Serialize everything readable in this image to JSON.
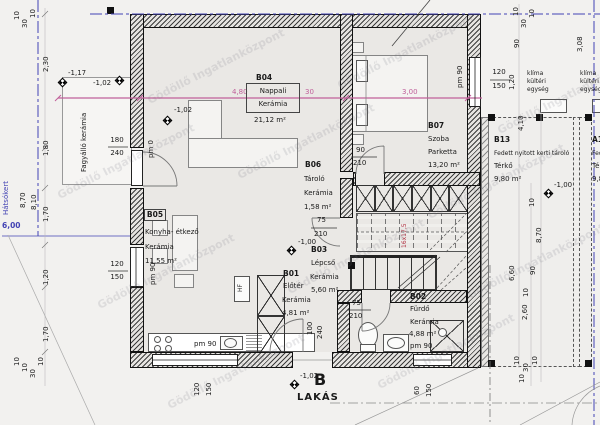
{
  "watermark": "Gödöllő Ingatlanközpont",
  "title": {
    "letter": "B",
    "word": "LAKÁS"
  },
  "rooms": {
    "b01": {
      "id": "B01",
      "name": "Előtér",
      "floor": "Kerámia",
      "area": "4,81 m²"
    },
    "b02": {
      "id": "B02",
      "name": "Fürdő",
      "floor": "Kerámia",
      "area": "4,88 m²",
      "parapet": "pm 90"
    },
    "b03": {
      "id": "B03",
      "name": "Lépcső",
      "floor": "Kerámia",
      "area": "5,60 m²"
    },
    "b04": {
      "id": "B04",
      "name": "Nappali",
      "floor": "Kerámia",
      "area": "21,12 m²"
    },
    "b05": {
      "id": "B05",
      "name": "Konyha- étkező",
      "floor": "Kerámia",
      "area": "11,55 m²"
    },
    "b06": {
      "id": "B06",
      "name": "Tároló",
      "floor": "Kerámia",
      "area": "1,58 m²"
    },
    "b07": {
      "id": "B07",
      "name": "Szoba",
      "floor": "Parketta",
      "area": "13,20 m²",
      "parapet": "pm 90"
    },
    "b13": {
      "id": "B13",
      "name": "Fedett nyitott kerti tároló",
      "floor": "Térkő",
      "area": "9,80 m²"
    },
    "a13": {
      "id": "A13",
      "name": "Fedett nyitott kerti tároló",
      "floor": "Térkő",
      "area": "9,80 m²"
    }
  },
  "site": {
    "backyard": "Hátsókert",
    "backyard_width": "6,00",
    "terrace_finish": "Fagyálló kerámia",
    "ac_l1": "klíma",
    "ac_l2": "kültéri",
    "ac_l3": "egység",
    "hf": "HF",
    "stair_note": "16x17,5",
    "pm0": "pm 0",
    "pm90": "pm 90"
  },
  "levels": {
    "m117": "-1,17",
    "m102": "-1,02",
    "m100": "-1,00"
  },
  "dims": {
    "n10": "10",
    "n30": "30",
    "n60": "60",
    "n75": "75",
    "n90": "90",
    "n100": "100",
    "n120": "120",
    "n150": "150",
    "n180": "180",
    "n210": "210",
    "n240": "240",
    "m120": "1,20",
    "m170": "1,70",
    "m180": "1,80",
    "m230": "2,30",
    "m260": "2,60",
    "m300": "3,00",
    "m308": "3,08",
    "m410": "4,10",
    "m480": "4,80",
    "m660": "6,60",
    "m810": "8,10",
    "m870": "8,70"
  },
  "colors": {
    "dim_line": "#c0609a",
    "boundary": "#4343b4",
    "stair_note": "#b03040"
  }
}
